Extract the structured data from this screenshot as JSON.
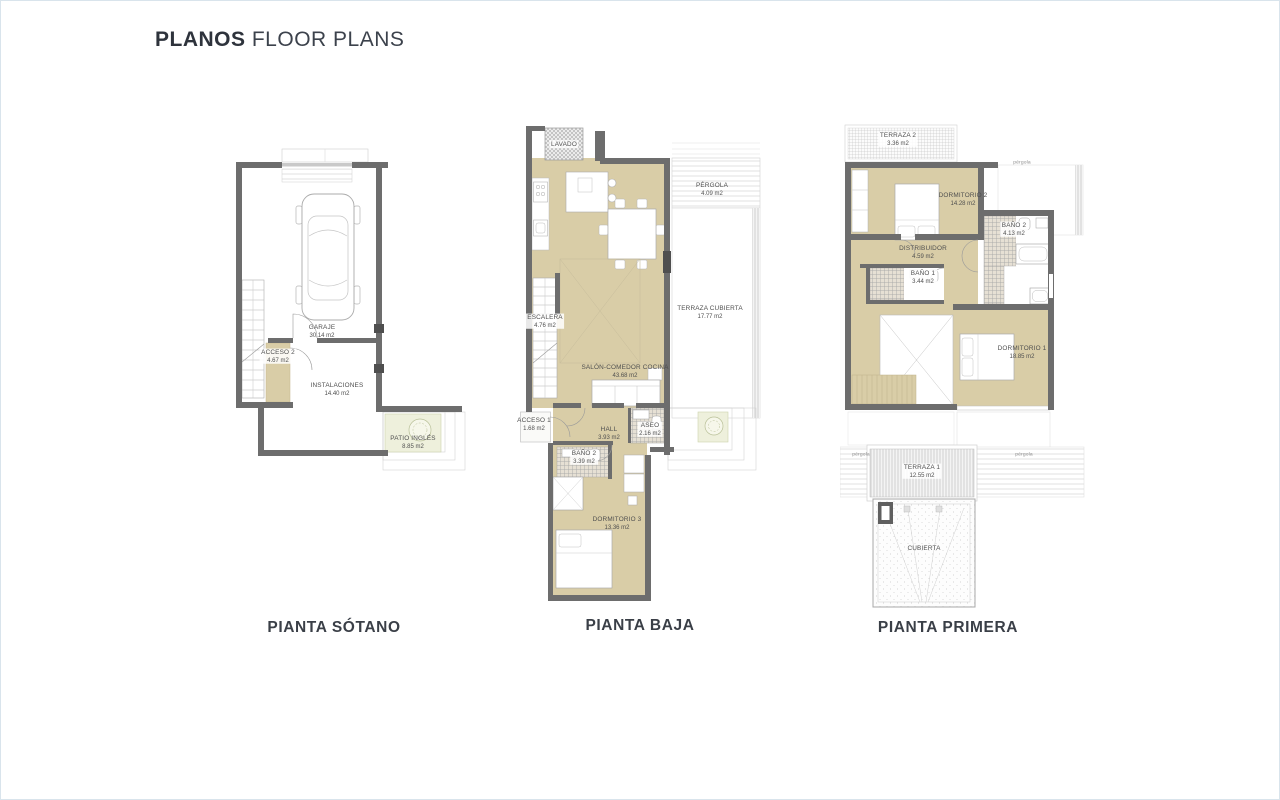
{
  "page": {
    "title_bold": "PLANOS",
    "title_light": "FLOOR PLANS"
  },
  "plans": [
    {
      "caption": "PIANTA SÓTANO",
      "rooms": [
        {
          "name": "GARAJE",
          "area": "30.14 m2"
        },
        {
          "name": "ACCESO 2",
          "area": "4.67 m2"
        },
        {
          "name": "INSTALACIONES",
          "area": "14.40 m2"
        },
        {
          "name": "PATIO INGLÉS",
          "area": "8.85 m2"
        }
      ]
    },
    {
      "caption": "PIANTA BAJA",
      "rooms": [
        {
          "name": "LAVADO",
          "area": ""
        },
        {
          "name": "PÉRGOLA",
          "area": "4.09 m2"
        },
        {
          "name": "TERRAZA CUBIERTA",
          "area": "17.77 m2"
        },
        {
          "name": "ESCALERA",
          "area": "4.76 m2"
        },
        {
          "name": "SALÓN-COMEDOR COCINA",
          "area": "43.68 m2"
        },
        {
          "name": "ACCESO 1",
          "area": "1.68 m2"
        },
        {
          "name": "HALL",
          "area": "3.93 m2"
        },
        {
          "name": "ASEO",
          "area": "2.16 m2"
        },
        {
          "name": "BAÑO 2",
          "area": "3.39 m2"
        },
        {
          "name": "DORMITORIO 3",
          "area": "13.36 m2"
        }
      ]
    },
    {
      "caption": "PIANTA PRIMERA",
      "rooms": [
        {
          "name": "TERRAZA 2",
          "area": "3.36 m2"
        },
        {
          "name": "pérgola",
          "area": ""
        },
        {
          "name": "DORMITORIO 2",
          "area": "14.28 m2"
        },
        {
          "name": "BAÑO 2",
          "area": "4.13 m2"
        },
        {
          "name": "DISTRIBUIDOR",
          "area": "4.59 m2"
        },
        {
          "name": "BAÑO 1",
          "area": "3.44 m2"
        },
        {
          "name": "DORMITORIO 1",
          "area": "18.85 m2"
        },
        {
          "name": "pérgola",
          "area": ""
        },
        {
          "name": "TERRAZA 1",
          "area": "12.55 m2"
        },
        {
          "name": "CUBIERTA",
          "area": ""
        },
        {
          "name": "pérgola",
          "area": ""
        }
      ]
    }
  ]
}
